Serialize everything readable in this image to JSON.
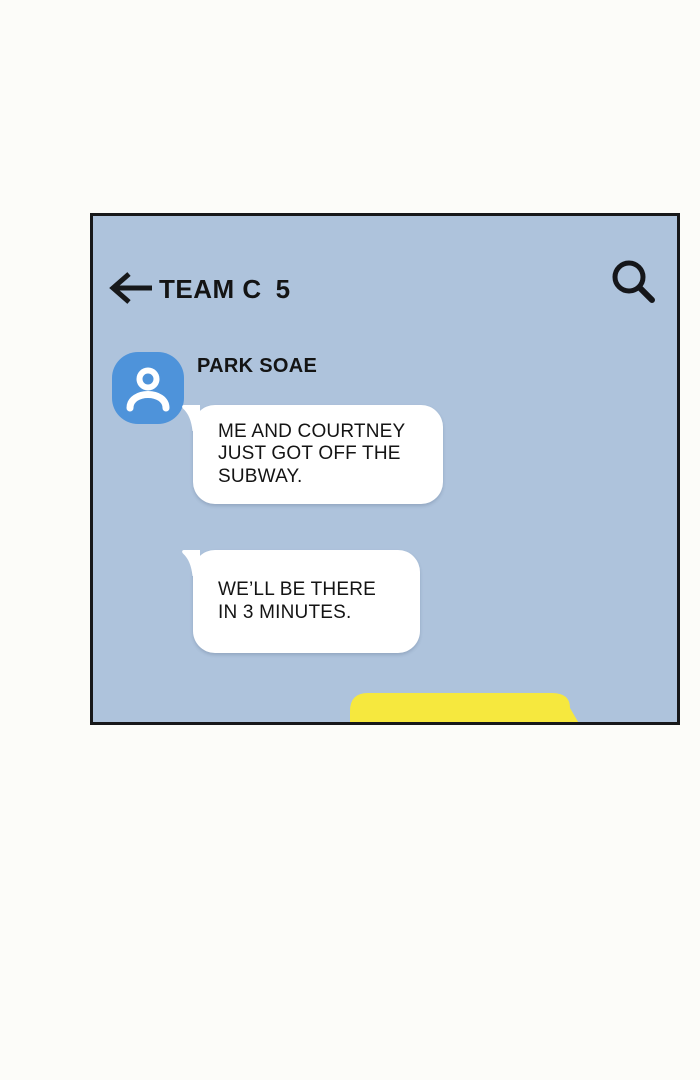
{
  "page": {
    "background_color": "#fcfcf9"
  },
  "panel": {
    "background_color": "#aec3dc",
    "frame_color": "#17181a",
    "header": {
      "back_icon": "arrow-left",
      "title": "TEAM C",
      "member_count": "5",
      "search_icon": "magnifying-glass",
      "text_color": "#141414"
    },
    "conversation": {
      "sender": {
        "name": "PARK SOAE",
        "avatar_icon": "person-silhouette",
        "avatar_color": "#4e93da",
        "avatar_icon_color": "#ffffff"
      },
      "messages": [
        {
          "text": "ME AND COURTNEY\nJUST GOT OFF THE\nSUBWAY.",
          "bubble_color": "#ffffff",
          "text_color": "#141414",
          "side": "left"
        },
        {
          "text": "WE’LL BE THERE\nIN 3 MINUTES.",
          "bubble_color": "#ffffff",
          "text_color": "#141414",
          "side": "left"
        }
      ],
      "outgoing_bubble": {
        "bubble_color": "#f6e83e",
        "side": "right"
      }
    }
  }
}
